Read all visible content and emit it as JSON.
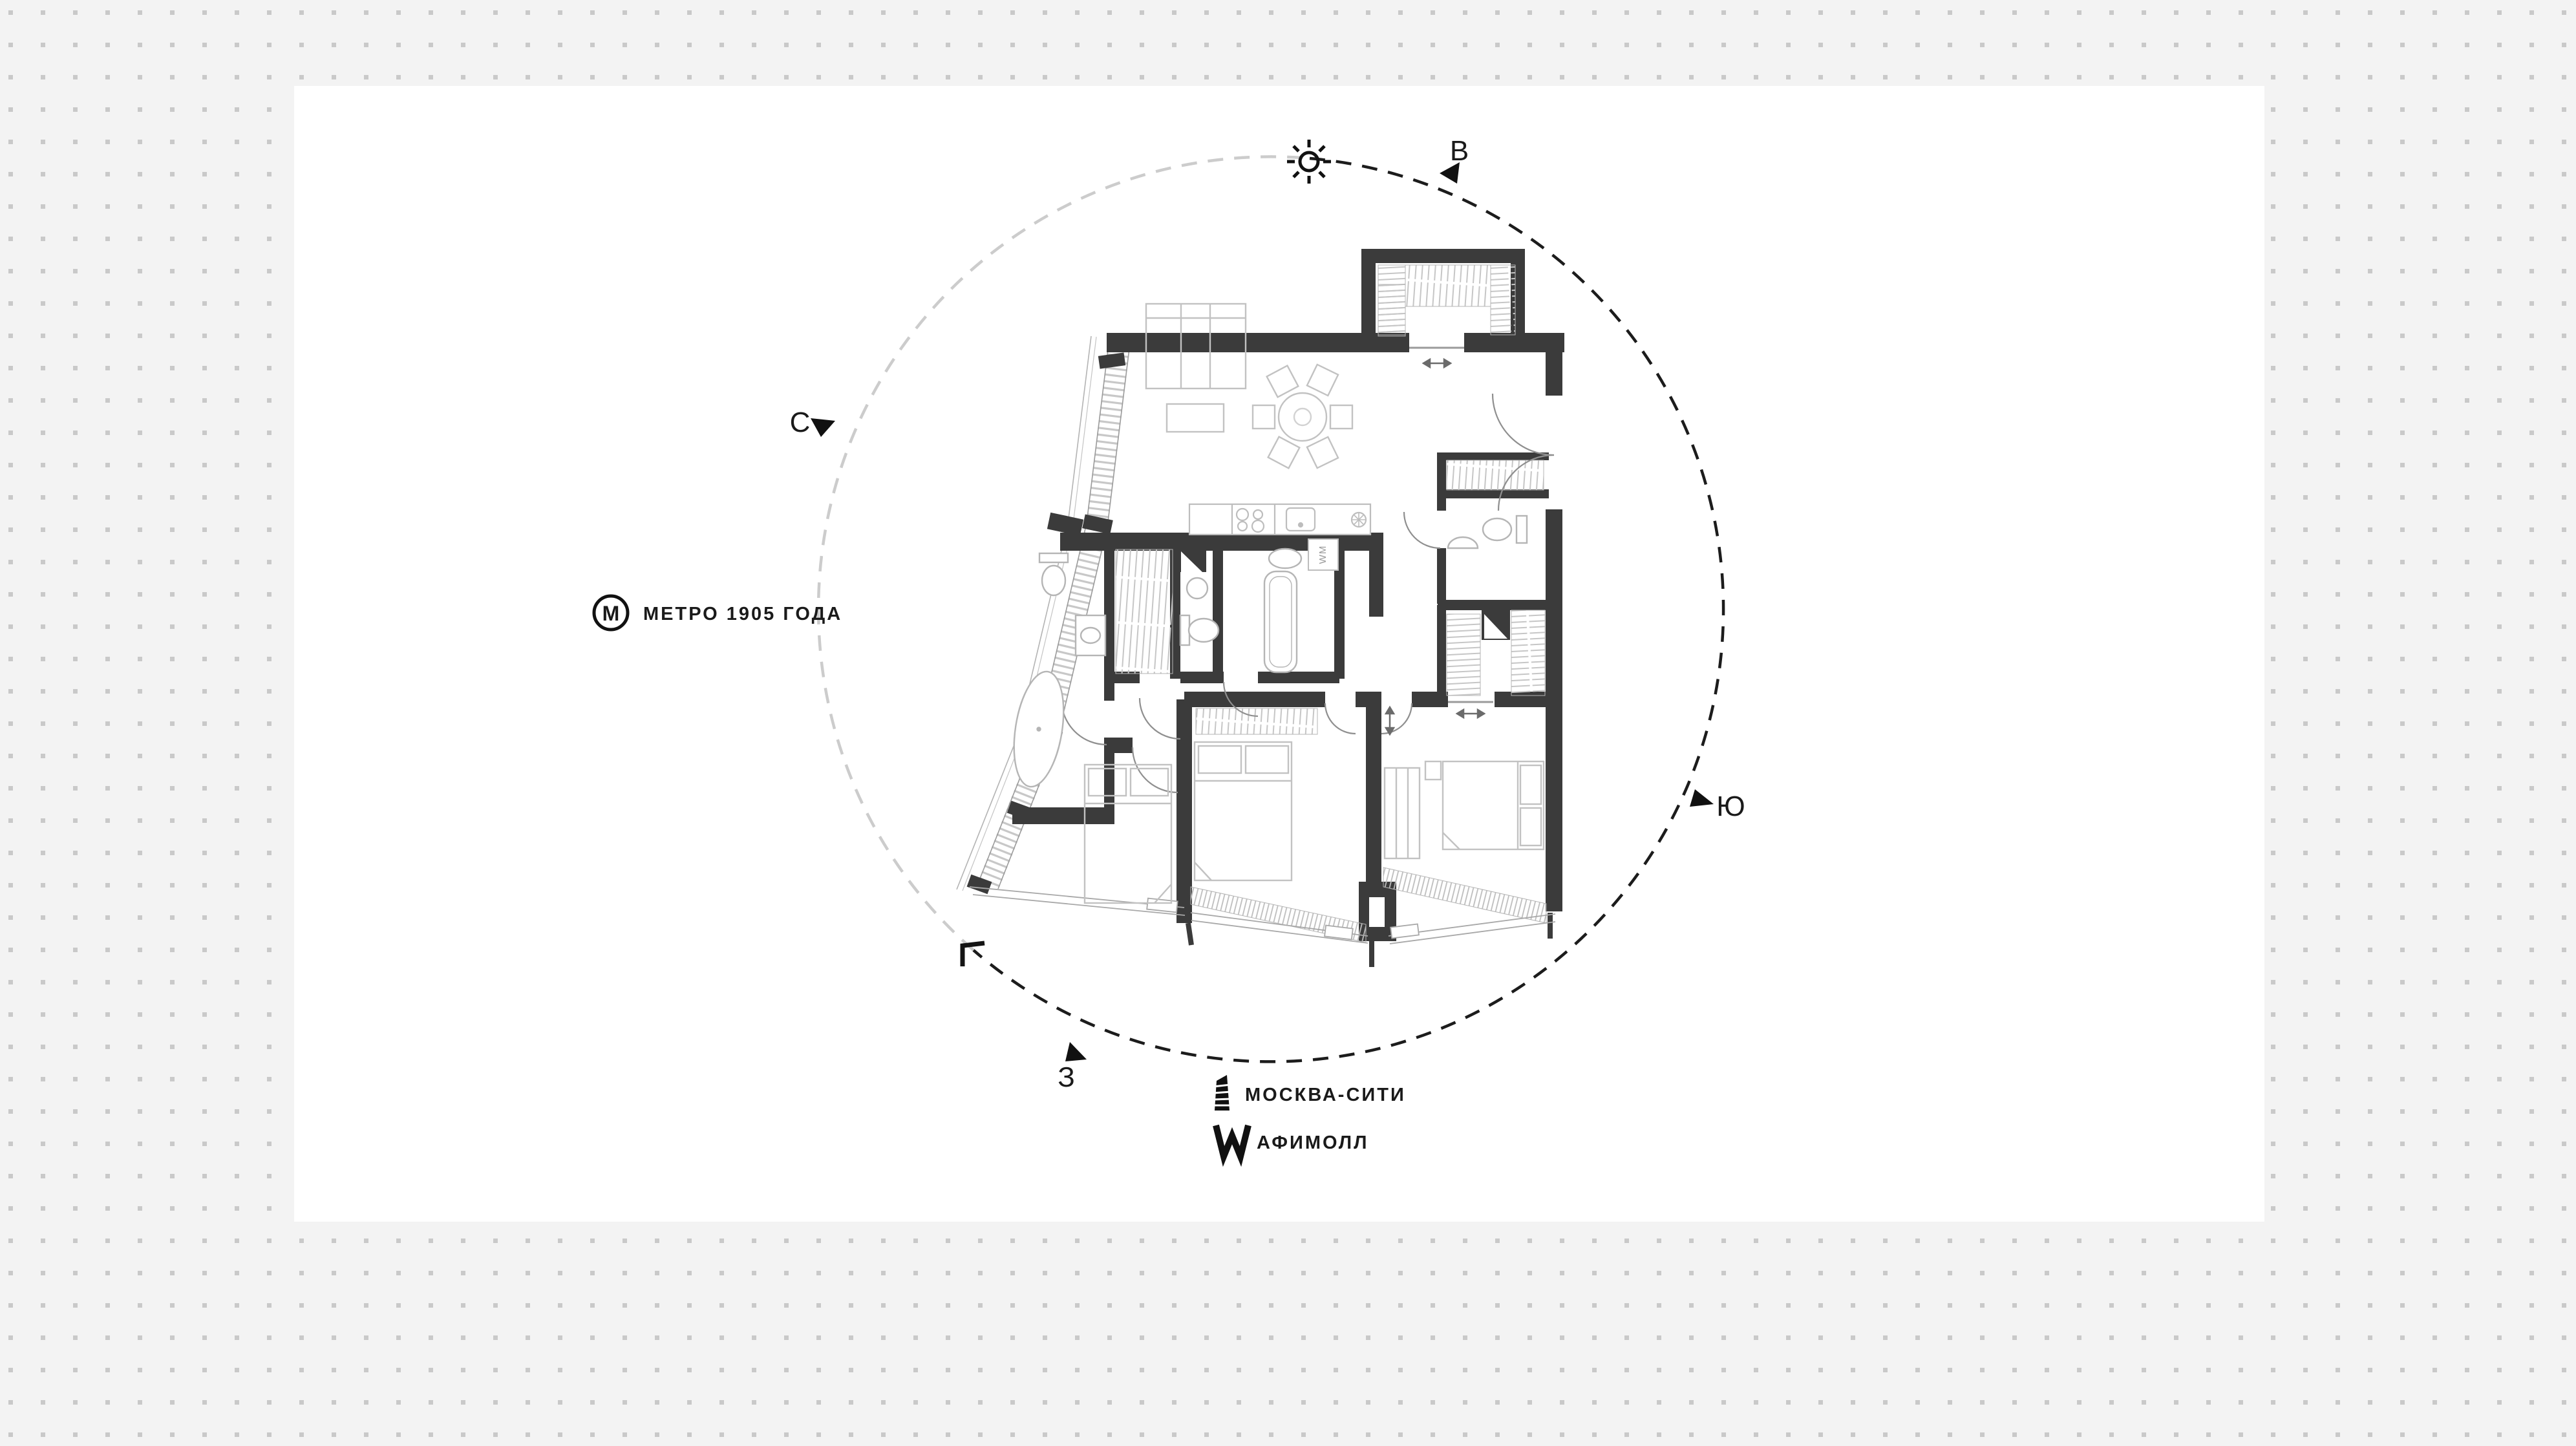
{
  "page": {
    "type": "apartment floor plan locator graphic",
    "background_color": "#f3f3f3",
    "dot_color": "#c9c9c9",
    "card_color": "#ffffff",
    "wall_color": "#3b3b3b",
    "circle_dash_dark": "#1c1c1c",
    "circle_dash_light": "#cccccc"
  },
  "compass": {
    "north_label": "С",
    "east_label": "В",
    "south_label": "Ю",
    "west_label": "З"
  },
  "landmarks": {
    "metro": {
      "icon_letter": "М",
      "label": "МЕТРО 1905 ГОДА"
    },
    "moscow_city": {
      "label": "МОСКВА-СИТИ"
    },
    "afimall": {
      "label": "АФИМОЛЛ"
    }
  },
  "plan": {
    "washing_machine_label": "WM"
  }
}
